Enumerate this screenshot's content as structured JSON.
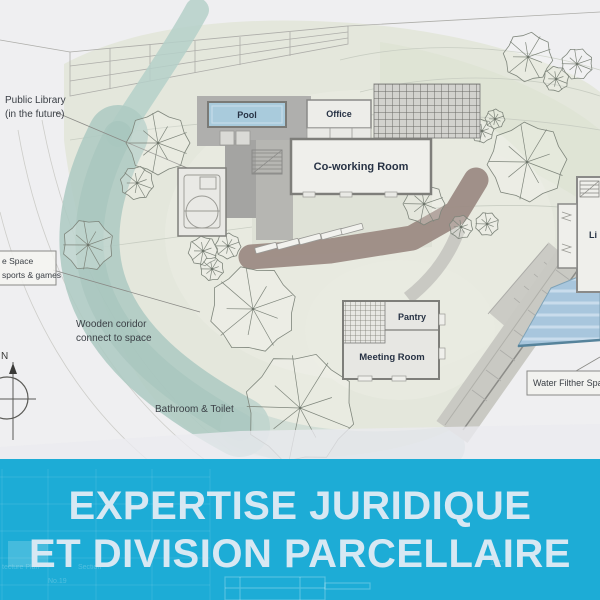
{
  "banner": {
    "line1": "EXPERTISE JURIDIQUE",
    "line2": "ET DIVISION PARCELLAIRE",
    "bg_color": "#1DACD6",
    "text_color": "#D7E8F3",
    "ghost_labels": {
      "plan": "tecture Plan",
      "section": "Section",
      "number": "No.19",
      "angle": "117°"
    }
  },
  "plan": {
    "room_labels": {
      "pool": "Pool",
      "office": "Office",
      "coworking": "Co-working Room",
      "pantry": "Pantry",
      "meeting_room": "Meeting Room",
      "library_partial": "Li"
    },
    "annotations": {
      "public_library_line1": "Public Library",
      "public_library_line2": "(in the future)",
      "free_space_line1": "e Space",
      "free_space_line2": "sports & games",
      "wooden_corridor_line1": "Wooden coridor",
      "wooden_corridor_line2": "connect to space",
      "bathroom": "Bathroom & Toilet",
      "water_filter": "Water Filther Space",
      "compass_north": "N"
    },
    "colors": {
      "banner_blue": "#1DACD6",
      "pool_water": "#A9CBDC",
      "river_teal": "#AECBC3",
      "corridor_brown": "#9C8B84",
      "site_sage": "#E4E7DC",
      "pond_blue": "#A8C6DD"
    }
  }
}
